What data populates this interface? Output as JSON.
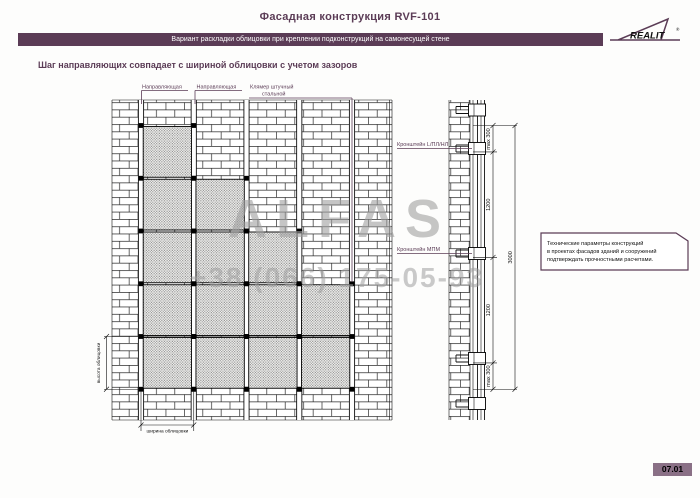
{
  "header": {
    "title": "Фасадная конструкция RVF-101",
    "banner": "Вариант раскладки облицовки при креплении подконструкций на самонесущей стене",
    "logo_text": "REALIT",
    "logo_reg": "®"
  },
  "subtitle": "Шаг направляющих совпадает с шириной облицовки с учетом зазоров",
  "elevation": {
    "labels": {
      "rail1": "Направляющая",
      "rail2": "Направляющая",
      "klamer_line1": "Клямер штучный",
      "klamer_line2": "стальной",
      "height": "высота облицовки",
      "width": "ширина облицовки"
    }
  },
  "section": {
    "labels": {
      "bracket_top": "Кронштейн L/ПЛ/НЛ",
      "bracket_mid": "Кронштейн МПМ"
    },
    "dimensions": {
      "top_offset": "max 300",
      "step_upper": "1200",
      "overall": "3000",
      "step_lower": "1200",
      "bottom_offset": "max 300"
    }
  },
  "note": {
    "line1": "Технические параметры конструкций",
    "line2": "в проектах фасадов зданий и сооружений",
    "line3": "подтверждать прочностными расчетами."
  },
  "watermark": {
    "brand": "ALFAS",
    "phone": "+38 (066) 175-05-93"
  },
  "page_number": "07.01",
  "colors": {
    "maroon": "#5b3c56",
    "badge_bg": "#8a7086",
    "watermark_gray": "#a0a0a0"
  }
}
